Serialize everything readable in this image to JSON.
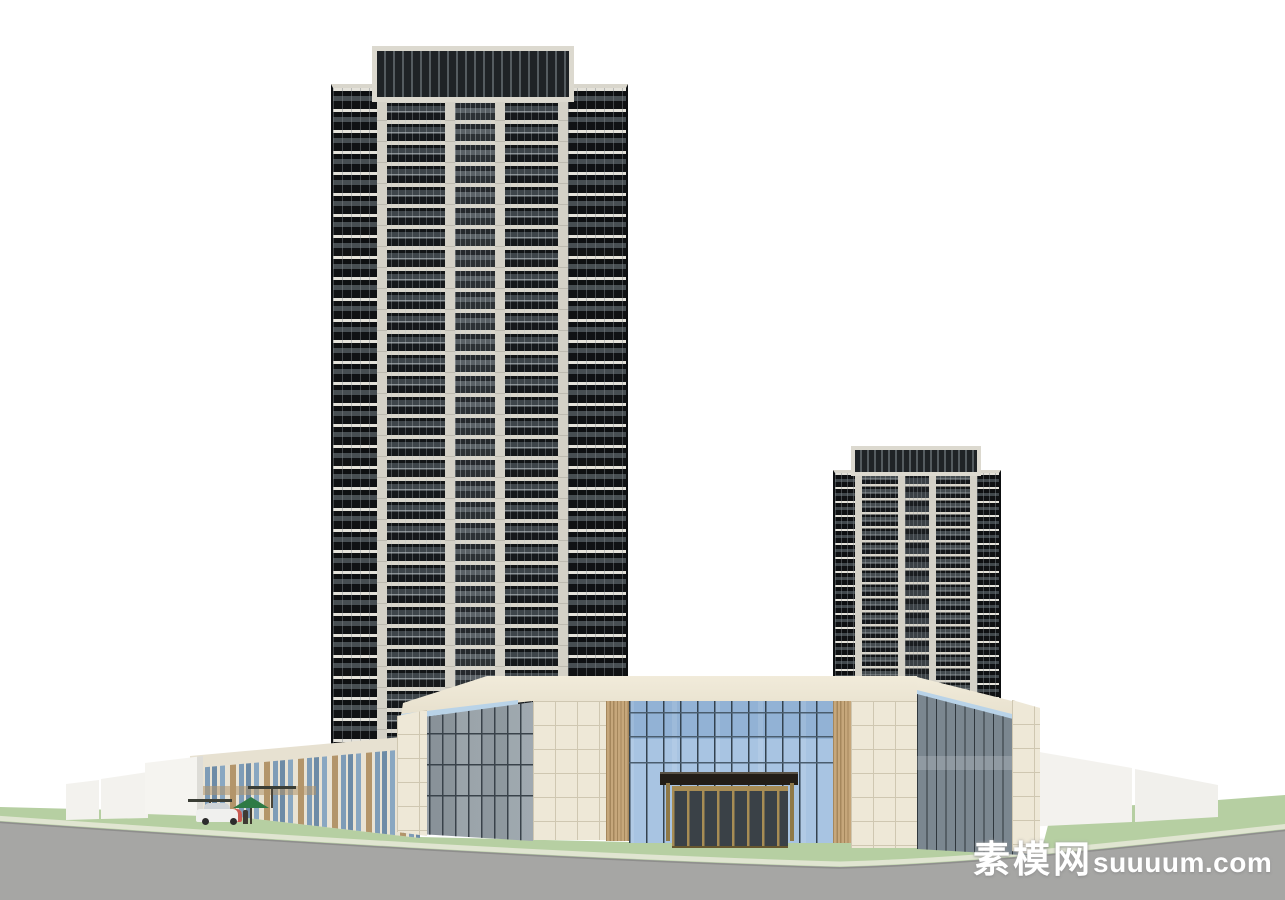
{
  "watermark": {
    "cjk": "素模网",
    "latin": "suuuum.com",
    "full_text": "素模网suuuum.com"
  },
  "scene": {
    "type": "architectural-3d-model-render",
    "elements": {
      "left_tower": "high-rise residential tower, ~28 floors, dark glazed balconies with cream piers",
      "right_tower": "high-rise residential tower, ~16 floors, same facade family",
      "podium": "two-storey commercial podium with blue glass curtain wall, stone piers, wood slat strips",
      "entrance": "recessed entrance with dark flat canopy and bronze-framed glass doors",
      "annex": "low cream annex building with vertical window strips and tan piers",
      "site": "white boundary walls, lawn verge with curb, asphalt road, car, green parasol, figure, bare trees"
    }
  },
  "colors": {
    "lawn": "#b6cfa2",
    "road": "#a6a6a4",
    "curb": "#e0e5d1",
    "road_edge": "#8e8e8c",
    "stone": "#eee8d7",
    "stone_line": "#cfc7b1",
    "wood": "#c6a77b",
    "wood_dark": "#a5875c",
    "glass_blue": "#a8c4e2",
    "glass_mullion": "#33424f",
    "glass_gray": "#99a3aa",
    "glass_right": "#7b8790",
    "skylight": "#b9d3e8",
    "tower_slab": "#d8d5cb",
    "tower_dark": "#15181b",
    "gold": "#a78c54",
    "canopy": "#221d17",
    "door_glass": "#3a4147",
    "white_wall": "#f3f2ee",
    "cream_face": "#ebe5d6",
    "tan_pier": "#b3956a",
    "umbrella": "#2e7a45",
    "watermark": "#ffffff"
  }
}
